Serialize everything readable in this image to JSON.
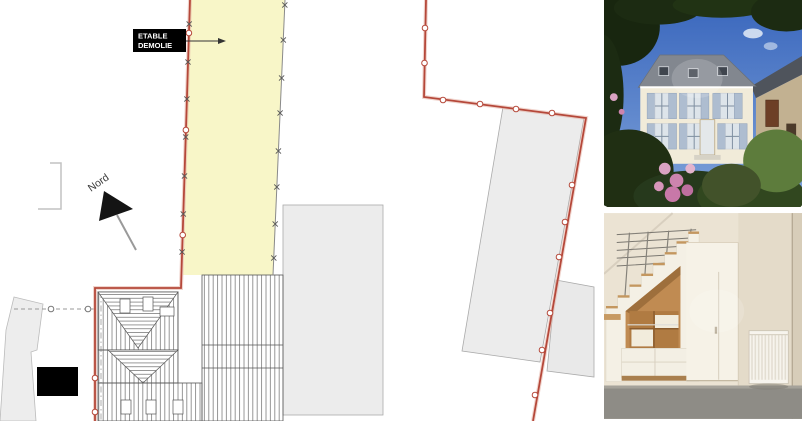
{
  "plan": {
    "stable_label_line1": "ETABLE",
    "stable_label_line2": "DEMOLIE",
    "north_label": "Nord",
    "colors": {
      "parcel_yellow": "#f8f6c8",
      "boundary_red": "#b5483a",
      "building_gray": "#ececec",
      "hatch_gray": "#666666",
      "label_background": "#000000",
      "label_text": "#ffffff"
    }
  },
  "photos": {
    "house_exterior": {
      "colors": {
        "sky": "#3f6fc4",
        "foliage": "#1c2b12",
        "facade": "#f1ebd9",
        "roof_slate": "#82878f",
        "shutters": "#aebdd0",
        "barn_wall": "#c2b191",
        "barn_door": "#6d3f26",
        "flowers_pink": "#d9a0c2"
      }
    },
    "interior_staircase": {
      "colors": {
        "wall": "#ebe3d3",
        "wood_oak": "#c08b52",
        "floor_concrete": "#8e8c86",
        "cabinet_white": "#f5f1e6",
        "railing_metal": "#7a7770"
      }
    }
  }
}
